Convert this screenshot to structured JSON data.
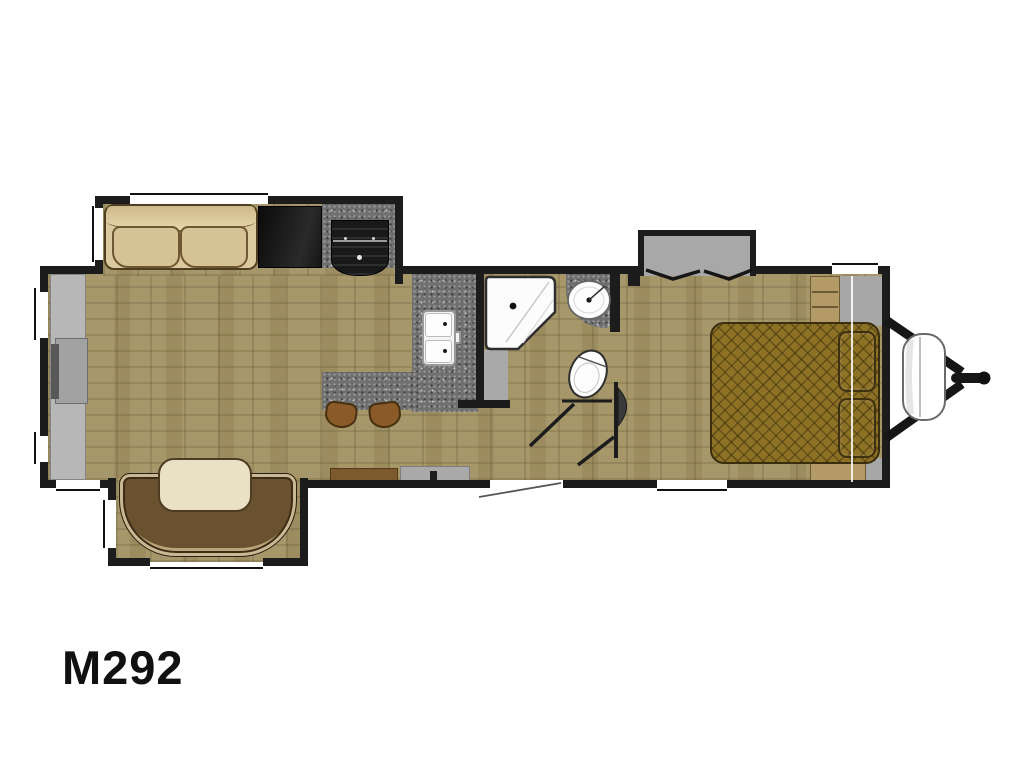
{
  "model": {
    "label": "M292"
  },
  "floorplan": {
    "vehicle_type": "travel-trailer-floorplan",
    "rooms": [
      "living-area",
      "kitchen",
      "bathroom",
      "bedroom"
    ],
    "fixtures": [
      "sofa-slideout",
      "tv-cabinet",
      "refrigerator",
      "range",
      "kitchen-double-sink",
      "bar-counter",
      "bar-stools",
      "u-dinette-slideout",
      "dinette-table",
      "neo-angle-shower",
      "bathroom-sink",
      "toilet",
      "front-wardrobe-slideout",
      "queen-bed",
      "pillows",
      "entry-door",
      "propane-tank",
      "a-frame-hitch"
    ],
    "colors": {
      "wall": "#1c1c1c",
      "floor": "#a6976b",
      "granite_counter": "#6f6f6f",
      "sofa": "#d9c79d",
      "bed": "#8d7226",
      "dinette_bench": "#6a5130",
      "dinette_table": "#e9e0c6",
      "slideout_gray": "#a8a8a8",
      "stool_wood": "#8a5a28",
      "cabinet_wood": "#7d5a2e"
    }
  }
}
